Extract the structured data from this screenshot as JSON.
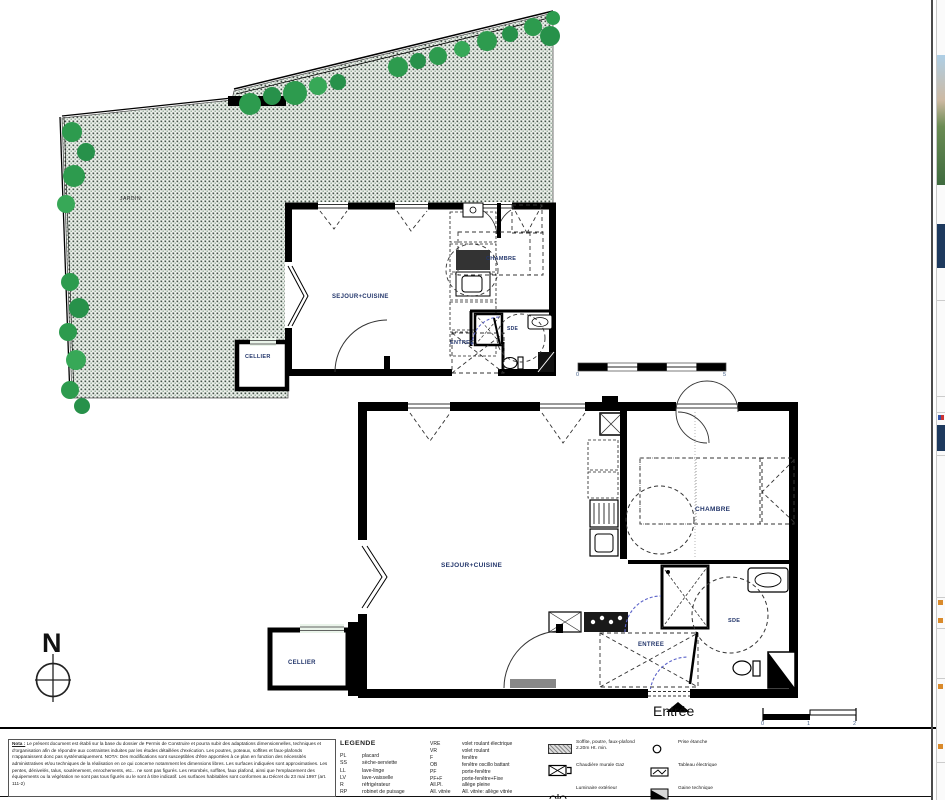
{
  "colors": {
    "label_navy": "#23366b",
    "tree_green": "#2d9b4e",
    "garden_base": "#eef2ec",
    "wall_black": "#000000",
    "sliver_navy": "#1e3a5e",
    "sliver_orange": "#d98a2b"
  },
  "compass": {
    "north": "N"
  },
  "garden": {
    "label": "JARDIN"
  },
  "apt1": {
    "sejour_cuisine": "SEJOUR+CUISINE",
    "chambre": "CHAMBRE",
    "entree": "ENTREE",
    "sde": "SDE",
    "cellier": "CELLIER"
  },
  "apt2": {
    "sejour_cuisine": "SEJOUR+CUISINE",
    "chambre": "CHAMBRE",
    "entree": "ENTREE",
    "sde": "SDE",
    "cellier": "CELLIER"
  },
  "entrance_label": "Entrée",
  "scale_main": {
    "start": "0",
    "end": "5"
  },
  "scale_small": {
    "t0": "0",
    "t1": "1",
    "t2": "2"
  },
  "note": {
    "title": "Nota :",
    "body": "Le présent document est établi sur la base du dossier de Permis de Construire et pourra subir des adaptations dimensionnelles, techniques et d'organisation afin de répondre aux contraintes induites par les études détaillées d'exécution. Les poutres, poteaux, soffites et faux-plafonds n'apparaissent donc pas systématiquement. NOTA: Des modifications sont susceptibles d'être apportées à ce plan en fonction des nécessités administratives et/ou techniques de la réalisation en ce qui concerne notamment les dimensions libres. Les surfaces indiquées sont approximatives. Les pentes, dénivelés, talus, soutènement, enrochements, etc... ne sont pas figurés. Les retombés, soffites, faux plafond, ainsi que l'emplacement des équipements ou la végétation ne sont pas tous figurés ou le sont à titre indicatif. Les surfaces habitables sont conformes au Décret du 23 mai 1997 (art. 111-2)"
  },
  "legend": {
    "title": "LEGENDE",
    "abbreviations": [
      {
        "abbr": "PL",
        "label": "placard"
      },
      {
        "abbr": "SS",
        "label": "sèche-serviette"
      },
      {
        "abbr": "LL",
        "label": "lave-linge"
      },
      {
        "abbr": "LV",
        "label": "lave-vaisselle"
      },
      {
        "abbr": "R",
        "label": "réfrigérateur"
      },
      {
        "abbr": "RP",
        "label": "robinet de puisage"
      }
    ],
    "openings": [
      {
        "abbr": "VRE",
        "label": "volet roulant électrique"
      },
      {
        "abbr": "VR",
        "label": "volet roulant"
      },
      {
        "abbr": "F",
        "label": "fenêtre"
      },
      {
        "abbr": "OB",
        "label": "fenêtre oscillo battant"
      },
      {
        "abbr": "PF",
        "label": "porte-fenêtre"
      },
      {
        "abbr": "PF+F",
        "label": "porte-fenêtre+Fixe"
      },
      {
        "abbr": "All.Pl.",
        "label": "allège pleine"
      },
      {
        "abbr": "All. vitrée",
        "label": "All. vitrée: allège vitrée"
      }
    ],
    "symbols_a": [
      {
        "icon": "soffite-hatch-icon",
        "label": "Soffite, poutre, faux-plafond 2.20m Ht. min."
      },
      {
        "icon": "chaudiere-icon",
        "label": "Chaudière murale Gaz"
      },
      {
        "icon": "luminaire-icon",
        "label": "Luminaire extérieur"
      },
      {
        "icon": "talutage-icon",
        "label": "Talutage"
      }
    ],
    "symbols_b": [
      {
        "icon": "prise-etanche-icon",
        "label": "Prise étanche"
      },
      {
        "icon": "tableau-electrique-icon",
        "label": "Tableau électrique"
      },
      {
        "icon": "gaine-technique-icon",
        "label": "Gaine technique"
      },
      {
        "icon": "pmr-icon",
        "label": "Accessibilité PMR"
      }
    ]
  }
}
